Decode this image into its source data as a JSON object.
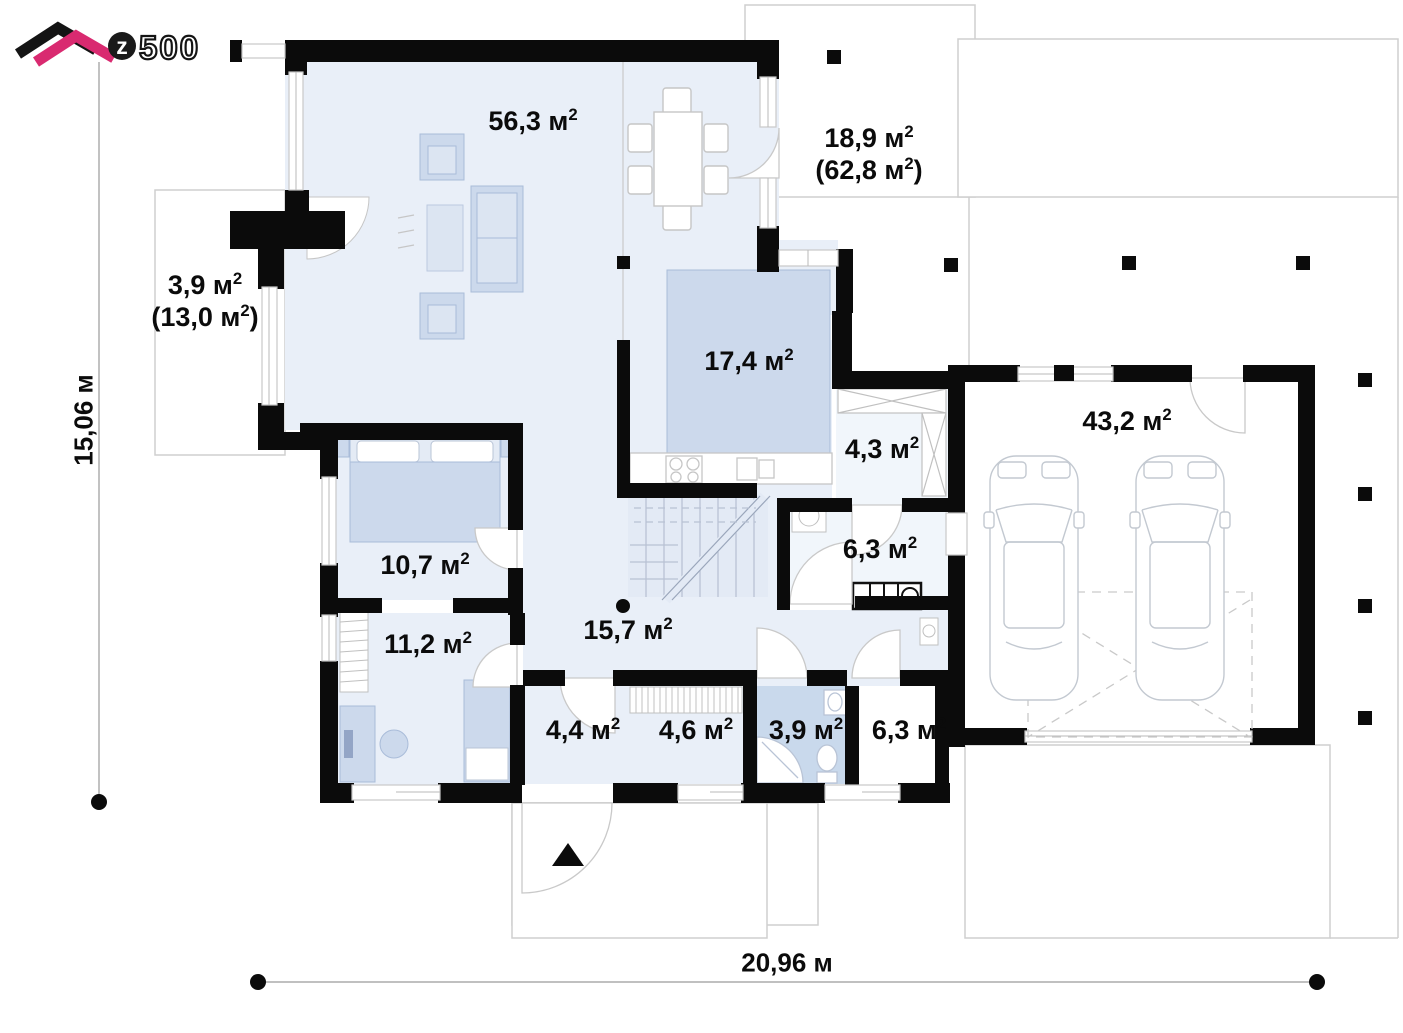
{
  "logo": {
    "z": "z",
    "numbers": "500"
  },
  "plan": {
    "rooms": [
      {
        "name": "living-room",
        "l1": [
          "56,3 м",
          "2",
          ""
        ]
      },
      {
        "name": "terrace-top",
        "l1": [
          "18,9 м",
          "2",
          ""
        ],
        "l2": [
          "(62,8 м",
          "2",
          ")"
        ]
      },
      {
        "name": "terrace-left",
        "l1": [
          "3,9 м",
          "2",
          ""
        ],
        "l2": [
          "(13,0 м",
          "2",
          ")"
        ]
      },
      {
        "name": "kitchen",
        "l1": [
          "17,4 м",
          "2",
          ""
        ]
      },
      {
        "name": "closet",
        "l1": [
          "4,3 м",
          "2",
          ""
        ]
      },
      {
        "name": "garage",
        "l1": [
          "43,2 м",
          "2",
          ""
        ]
      },
      {
        "name": "bedroom",
        "l1": [
          "10,7 м",
          "2",
          ""
        ]
      },
      {
        "name": "bathroom-upper",
        "l1": [
          "6,3 м",
          "2",
          ""
        ]
      },
      {
        "name": "cabinet",
        "l1": [
          "11,2 м",
          "2",
          ""
        ]
      },
      {
        "name": "hall",
        "l1": [
          "15,7 м",
          "2",
          ""
        ]
      },
      {
        "name": "vestibule",
        "l1": [
          "4,4 м",
          "2",
          ""
        ]
      },
      {
        "name": "wardrobe",
        "l1": [
          "4,6 м",
          "2",
          ""
        ]
      },
      {
        "name": "bathroom-lower",
        "l1": [
          "3,9 м",
          "2",
          ""
        ]
      },
      {
        "name": "tech-room",
        "l1": [
          "6,3 м",
          "2",
          ""
        ]
      }
    ],
    "dimensions": {
      "height": "15,06 м",
      "width": "20,96 м"
    },
    "colors": {
      "wall": "#0b0b0b",
      "floor": "#e9eff8",
      "furniture": "#ccd9ec",
      "bath_floor": "#c9d9ec",
      "logo_magenta": "#d92a70"
    }
  }
}
